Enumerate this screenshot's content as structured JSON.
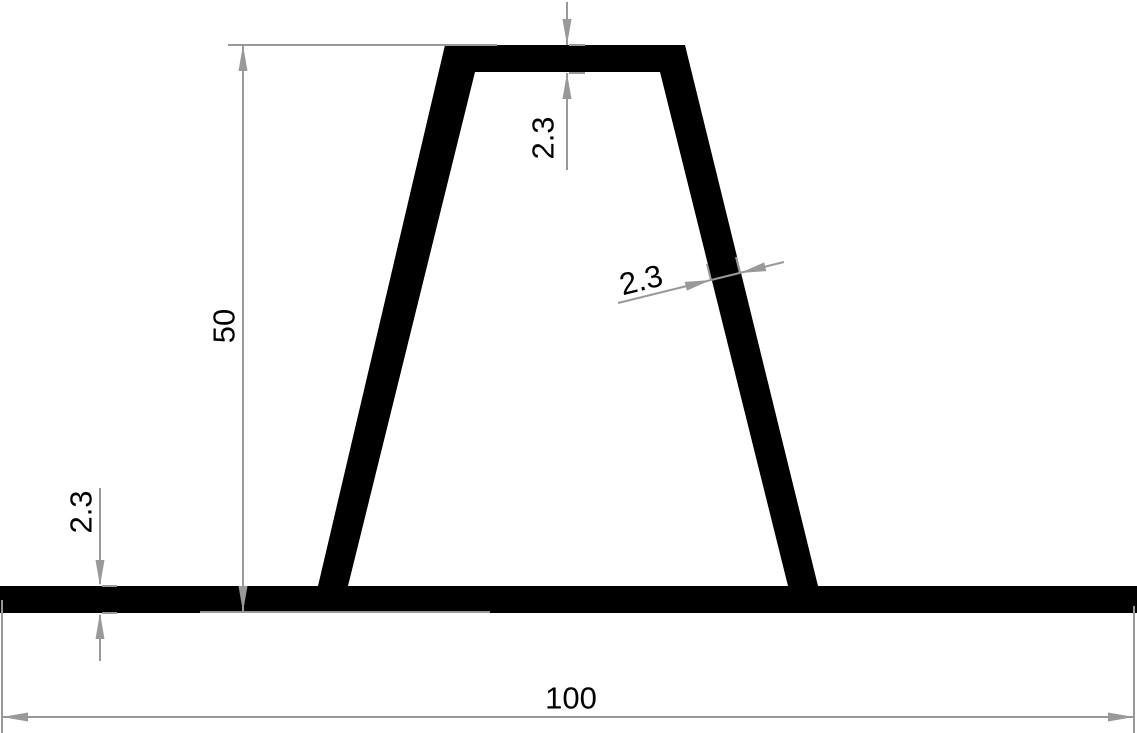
{
  "drawing": {
    "kind": "profile-cross-section"
  },
  "colors": {
    "background": "#ffffff",
    "profile": "#000000",
    "dimension": "#999999",
    "label_text": "#000000"
  },
  "dimensions": {
    "overall_width": {
      "label": "100"
    },
    "height": {
      "label": "50"
    },
    "top_wall_thickness": {
      "label": "2.3"
    },
    "side_wall_thickness": {
      "label": "2.3"
    },
    "base_thickness": {
      "label": "2.3"
    }
  }
}
